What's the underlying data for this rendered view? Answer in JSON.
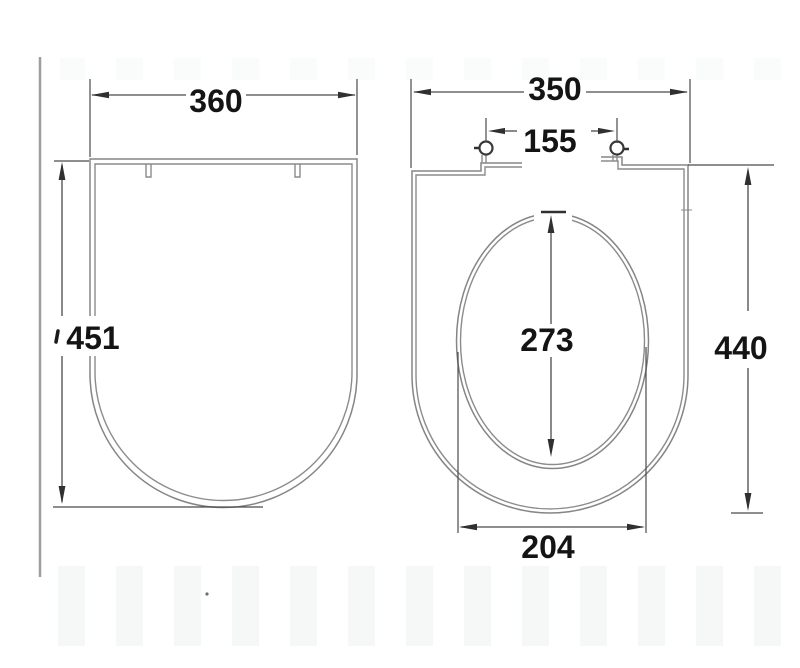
{
  "title": "Toilet seat and lid technical dimension drawing (top views)",
  "dims": {
    "lid_width": "360",
    "lid_height": "451",
    "seat_width": "350",
    "hinge_spacing": "155",
    "opening_height": "273",
    "seat_height": "440",
    "opening_width": "204"
  },
  "colors": {
    "background": "#ffffff",
    "shape_line": "#858585",
    "dimension_line": "#4a4a4a",
    "text": "#141414",
    "scan_artifact": "#9e9e9e",
    "band_artifact": "#eff1f1"
  }
}
